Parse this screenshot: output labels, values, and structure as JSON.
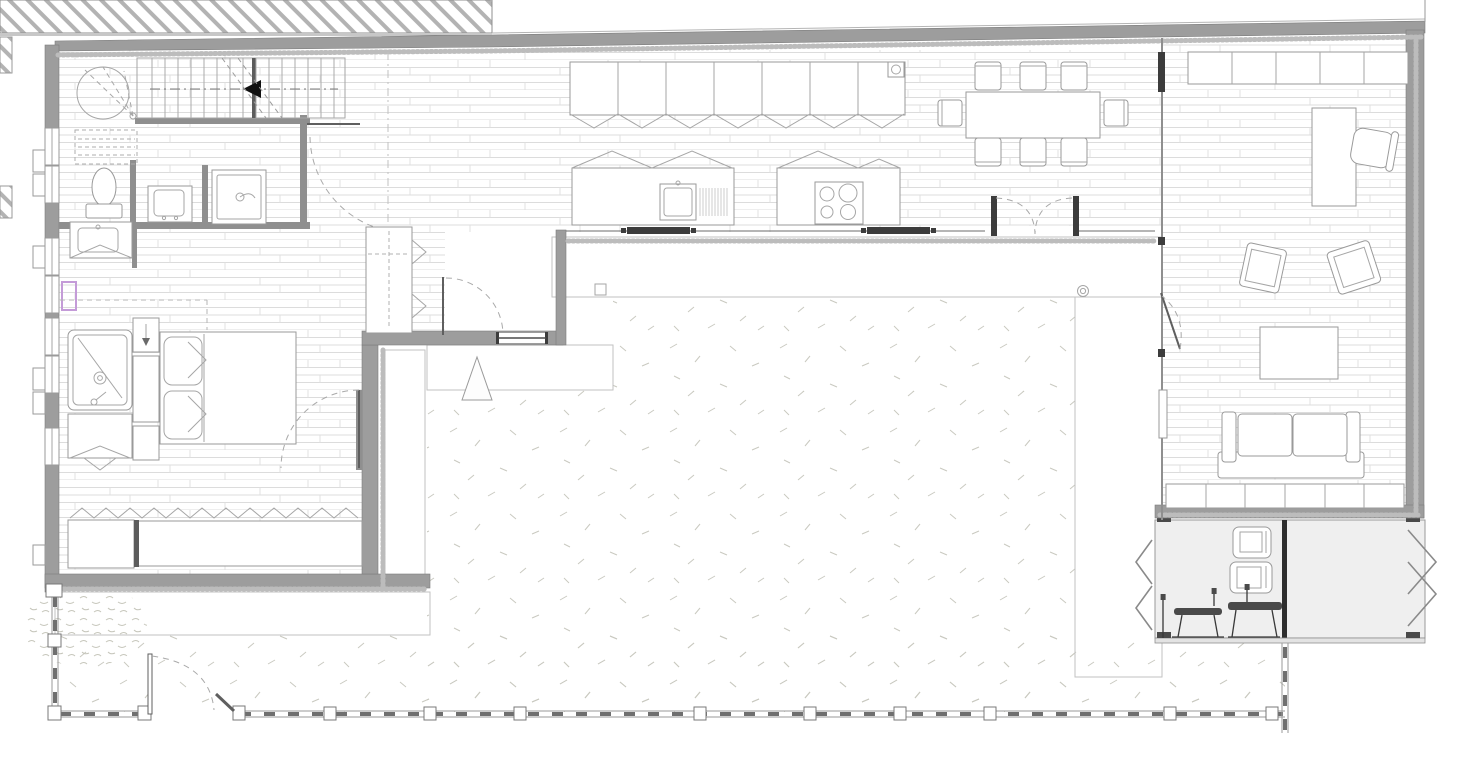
{
  "document": {
    "kind": "architectural floor plan",
    "level": "ground floor house around a courtyard",
    "style": "grayscale technical line drawing, no text labels visible"
  },
  "palette": {
    "paper": "#ffffff",
    "line": "#9a9a9a",
    "line_dark": "#3c3c3c",
    "wall_fill": "#9d9d9d",
    "floor_joint": "#dcdcdc",
    "stone_line": "#c4c4c4",
    "insulation_dot": "#bcbcbc",
    "deck_fill": "#efefef",
    "grass_mark": "#c9c9c0",
    "hatch": "#b3b3b3",
    "window_highlight": "#c49bd8",
    "arrow_black": "#111111"
  },
  "site": {
    "neighbor_building": "diagonal-hatch block along top edge",
    "courtyard_surface": "lawn with scattered grass ticks",
    "stone_walls": "rubble stone bands framing courtyard and south patio",
    "fence": {
      "style": "dashed rail with square posts",
      "post_count": 11,
      "gate_count": 1
    },
    "markers": {
      "courtyard_triangle": 1,
      "stone_drain_circle": 1
    }
  },
  "rooms": [
    {
      "name": "Stair hall",
      "items": [
        "winder stair",
        "straight flight",
        "down-direction arrow",
        "under-stair storage (dashed)"
      ]
    },
    {
      "name": "WC / shower room",
      "items": [
        "toilet",
        "hand basin",
        "shower cabin"
      ]
    },
    {
      "name": "Bathroom",
      "items": [
        "vanity basin",
        "walk-in shower",
        "base cabinet"
      ]
    },
    {
      "name": "Bedroom",
      "items": [
        "double bed",
        "two pillows",
        "wardrobe column",
        "window bench"
      ]
    },
    {
      "name": "Entry vestibule",
      "items": [
        "coat closet",
        "entry door",
        "porch window"
      ]
    },
    {
      "name": "Kitchen",
      "items": [
        "wall cabinet run",
        "island with sink and drainer",
        "cooktop",
        "sliding glass wall"
      ]
    },
    {
      "name": "Dining area",
      "items": [
        "dining table",
        "chairs",
        "french double doors"
      ]
    },
    {
      "name": "Living room",
      "items": [
        "sideboard",
        "desk",
        "task chair",
        "armchairs",
        "coffee table",
        "sofa",
        "media bench"
      ]
    },
    {
      "name": "Deck",
      "items": [
        "two wall appliances",
        "outdoor table set",
        "folding side screens",
        "center divider"
      ]
    },
    {
      "name": "Courtyard",
      "items": [
        "lawn",
        "stone retaining walls",
        "triangle marker"
      ]
    }
  ],
  "counts": {
    "dining_chairs": 8,
    "cooktop_burners": 4,
    "wall_cabinet_doors": 7,
    "sideboard_sections": 5,
    "media_bench_sections": 6,
    "stair_treads": 15,
    "left_wall_windows": 7,
    "fence_posts": 11,
    "deck_appliances": 2,
    "sofa_cushions": 2,
    "armchairs": 2
  }
}
